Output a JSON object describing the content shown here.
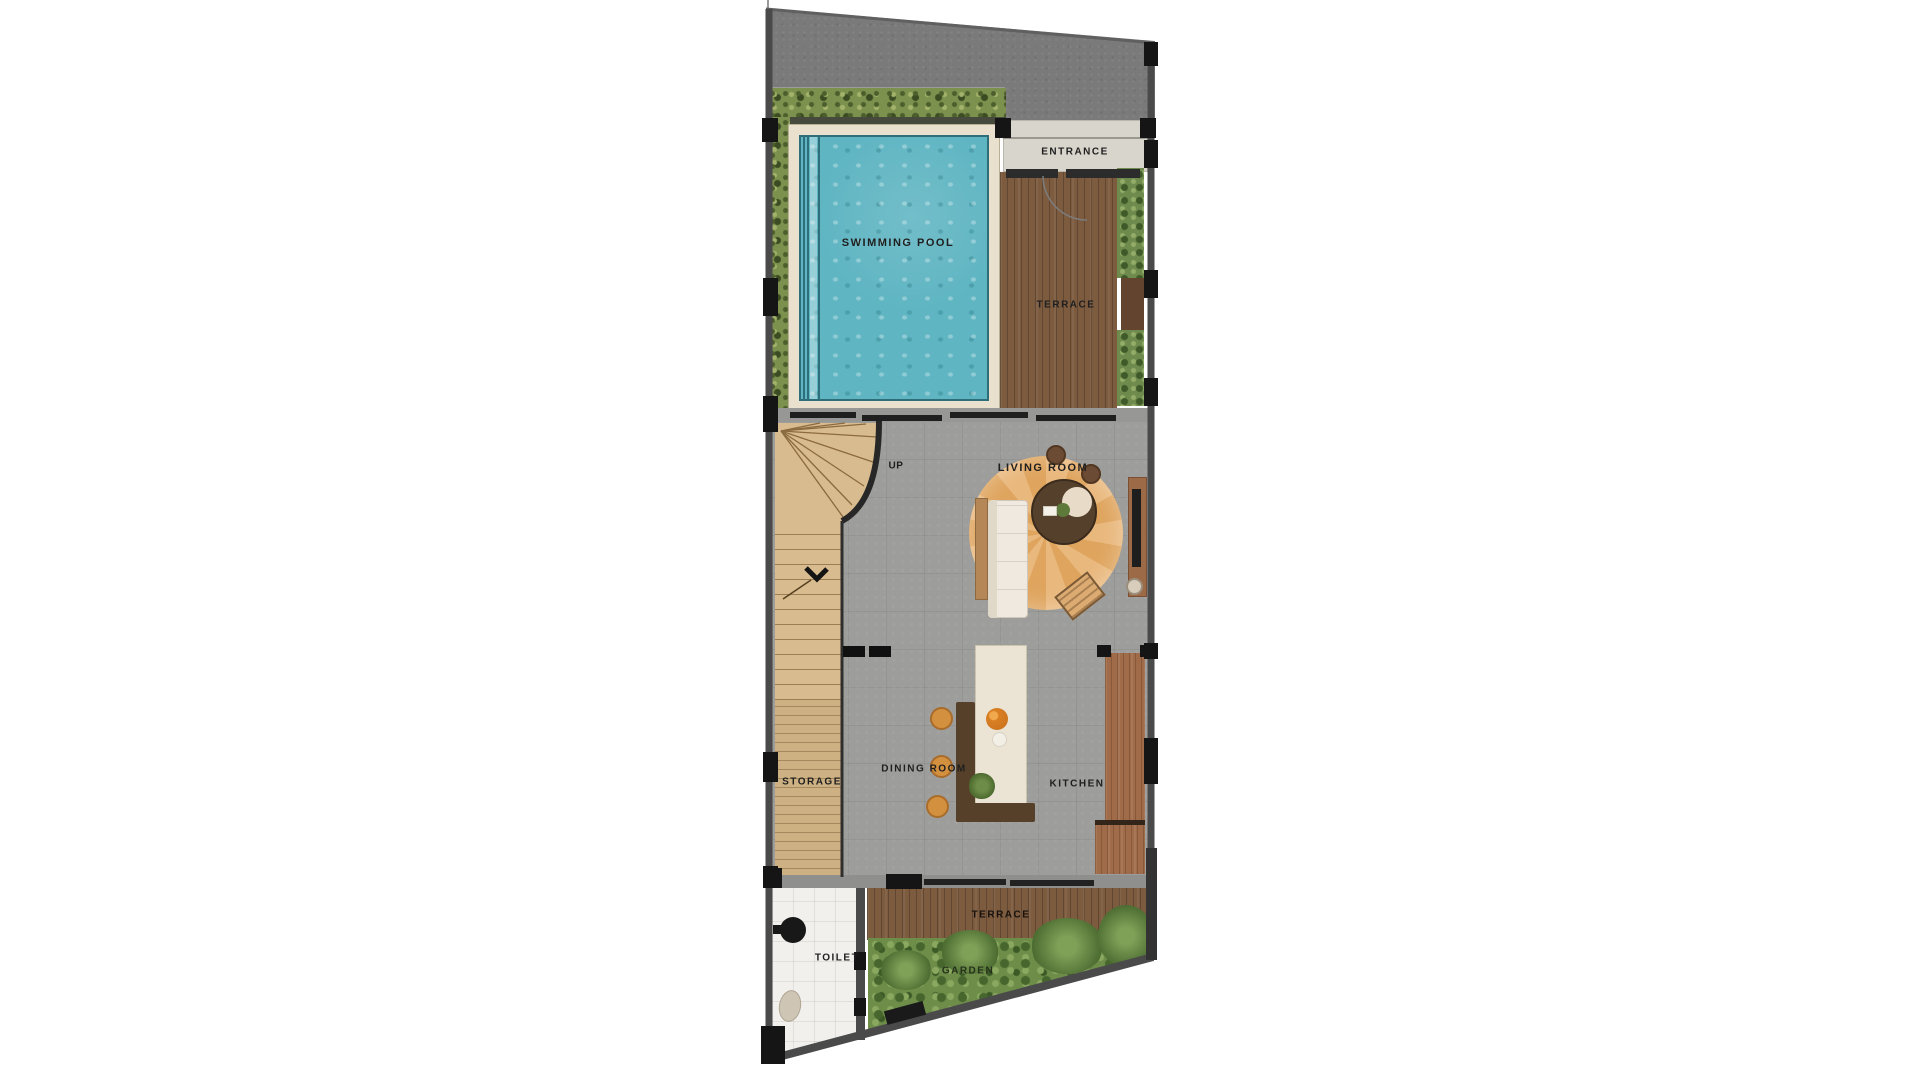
{
  "plan": {
    "title": "villa ground floor plan",
    "labels": {
      "swimming_pool": "SWIMMING POOL",
      "entrance": "ENTRANCE",
      "terrace_upper": "TERRACE",
      "living_room": "LIVING ROOM",
      "up": "UP",
      "storage": "STORAGE",
      "dining_room": "DINING ROOM",
      "kitchen": "KITCHEN",
      "terrace_lower": "TERRACE",
      "garden": "GARDEN",
      "toilet": "TOILET"
    },
    "palette": {
      "pool": "#5fb5c2",
      "deck": "#e9e1cd",
      "wood": "#7c5b3f",
      "stair": "#d8bb8f",
      "floor": "#9d9d9b",
      "grass": "#6d8d49",
      "hedge": "#7d914f",
      "asphalt": "#7a7a7a",
      "wall": "#4a4a4a",
      "accent": "#d3913f"
    }
  }
}
